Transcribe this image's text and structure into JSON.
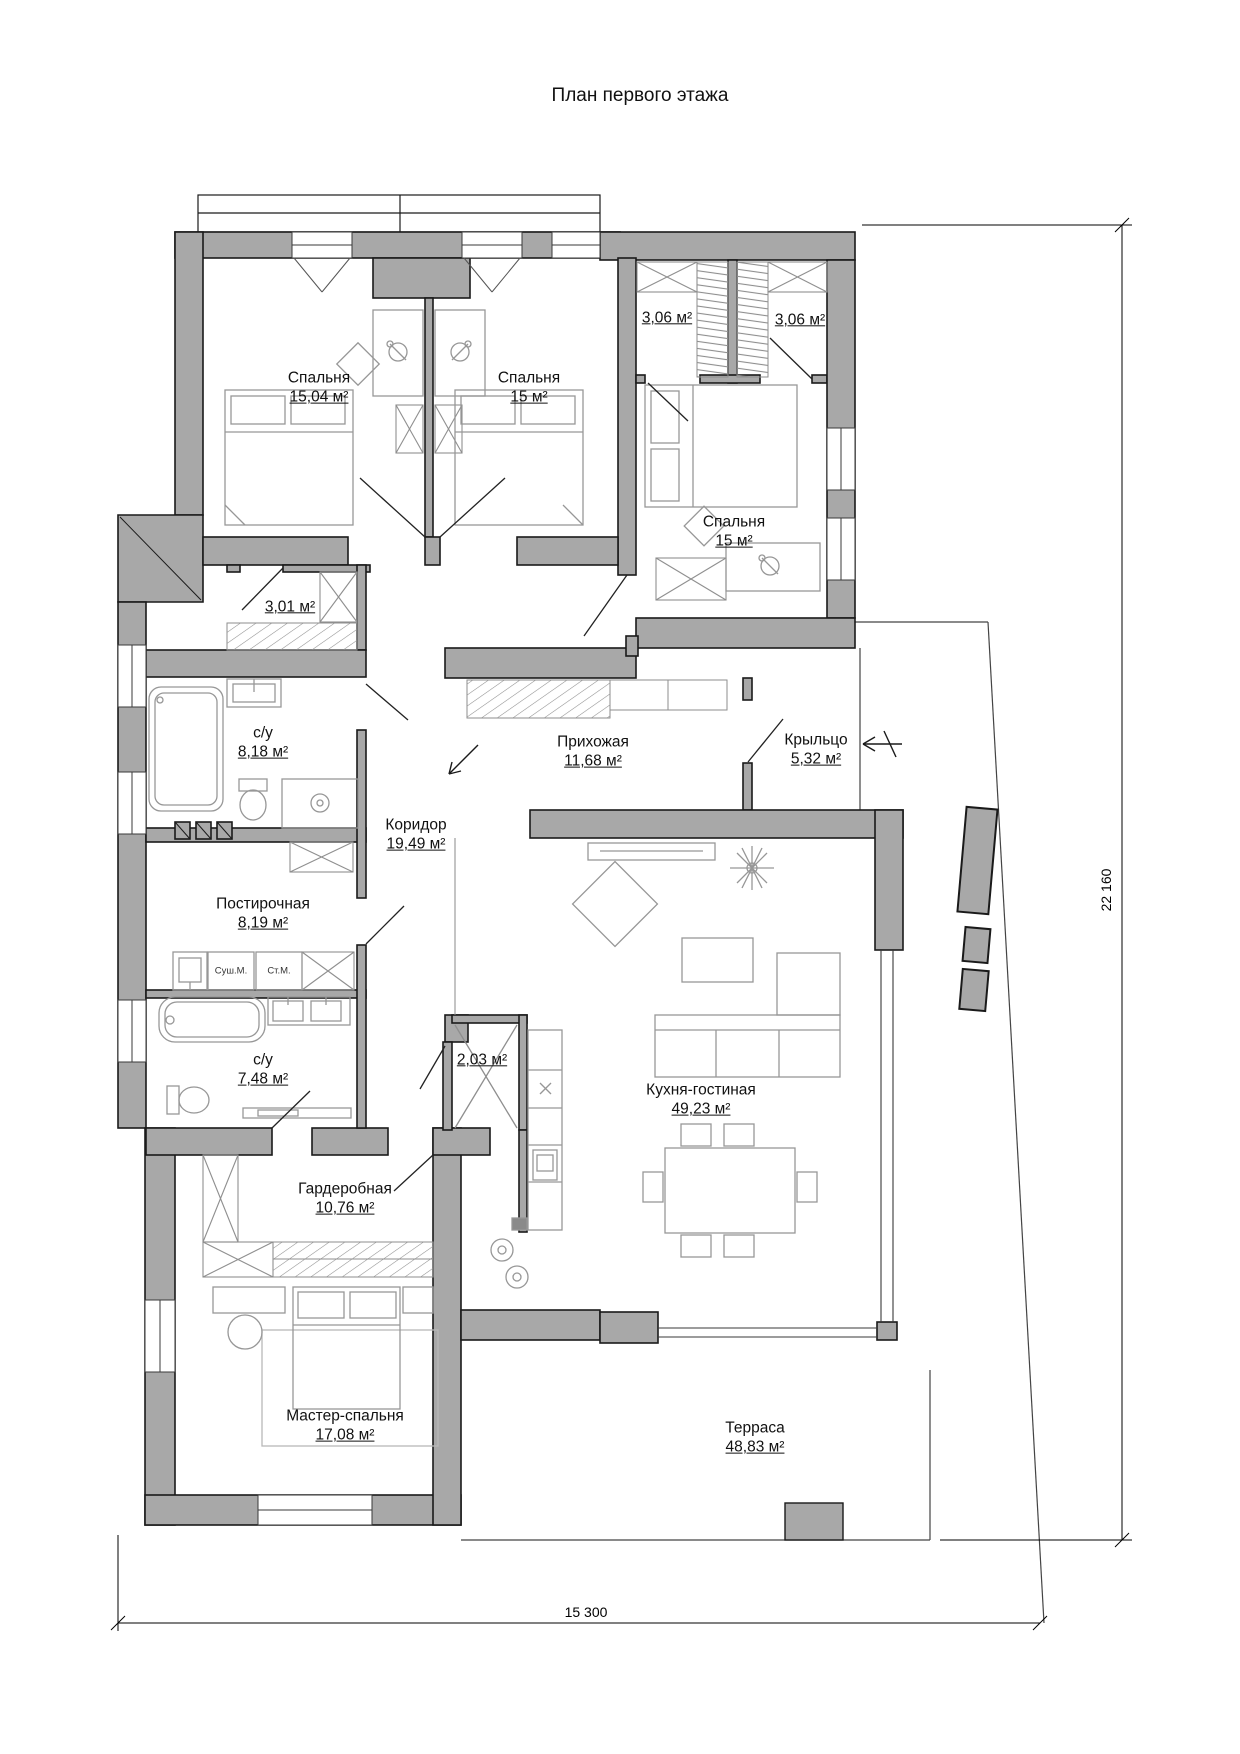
{
  "title": "План первого этажа",
  "plan": {
    "rooms": [
      {
        "id": "bedroom-1",
        "name": "Спальня",
        "area": "15,04 м²",
        "cx": 319,
        "cy": 388
      },
      {
        "id": "bedroom-2",
        "name": "Спальня",
        "area": "15 м²",
        "cx": 529,
        "cy": 388
      },
      {
        "id": "closet-left",
        "name": "",
        "area": "3,06 м²",
        "cx": 667,
        "cy": 318
      },
      {
        "id": "closet-right",
        "name": "",
        "area": "3,06 м²",
        "cx": 800,
        "cy": 320
      },
      {
        "id": "bedroom-3",
        "name": "Спальня",
        "area": "15 м²",
        "cx": 734,
        "cy": 532
      },
      {
        "id": "hall-closet",
        "name": "",
        "area": "3,01 м²",
        "cx": 290,
        "cy": 607
      },
      {
        "id": "bathroom-1",
        "name": "с/у",
        "area": "8,18 м²",
        "cx": 263,
        "cy": 743
      },
      {
        "id": "entry-hall",
        "name": "Прихожая",
        "area": "11,68 м²",
        "cx": 593,
        "cy": 752
      },
      {
        "id": "porch",
        "name": "Крыльцо",
        "area": "5,32 м²",
        "cx": 816,
        "cy": 750
      },
      {
        "id": "corridor",
        "name": "Коридор",
        "area": "19,49 м²",
        "cx": 416,
        "cy": 835
      },
      {
        "id": "laundry",
        "name": "Постирочная",
        "area": "8,19 м²",
        "cx": 263,
        "cy": 914
      },
      {
        "id": "bathroom-2",
        "name": "с/у",
        "area": "7,48 м²",
        "cx": 263,
        "cy": 1070
      },
      {
        "id": "pantry",
        "name": "",
        "area": "2,03 м²",
        "cx": 482,
        "cy": 1060
      },
      {
        "id": "wardrobe-room",
        "name": "Гардеробная",
        "area": "10,76 м²",
        "cx": 345,
        "cy": 1199
      },
      {
        "id": "kitchen-living",
        "name": "Кухня-гостиная",
        "area": "49,23 м²",
        "cx": 701,
        "cy": 1100
      },
      {
        "id": "master-bedroom",
        "name": "Мастер-спальня",
        "area": "17,08 м²",
        "cx": 345,
        "cy": 1426
      },
      {
        "id": "terrace",
        "name": "Терраса",
        "area": "48,83 м²",
        "cx": 755,
        "cy": 1438
      }
    ],
    "appliance_labels": [
      {
        "id": "dryer",
        "text": "Суш.М.",
        "cx": 231,
        "cy": 971
      },
      {
        "id": "washer",
        "text": "Ст.М.",
        "cx": 279,
        "cy": 971
      }
    ],
    "dimensions": {
      "right_vertical": "22 160",
      "bottom_horizontal": "15 300"
    },
    "colors": {
      "wall_fill": "#a8a8a8",
      "wall_stroke": "#1a1a1a",
      "furniture_stroke": "#979797",
      "background": "#ffffff"
    }
  }
}
